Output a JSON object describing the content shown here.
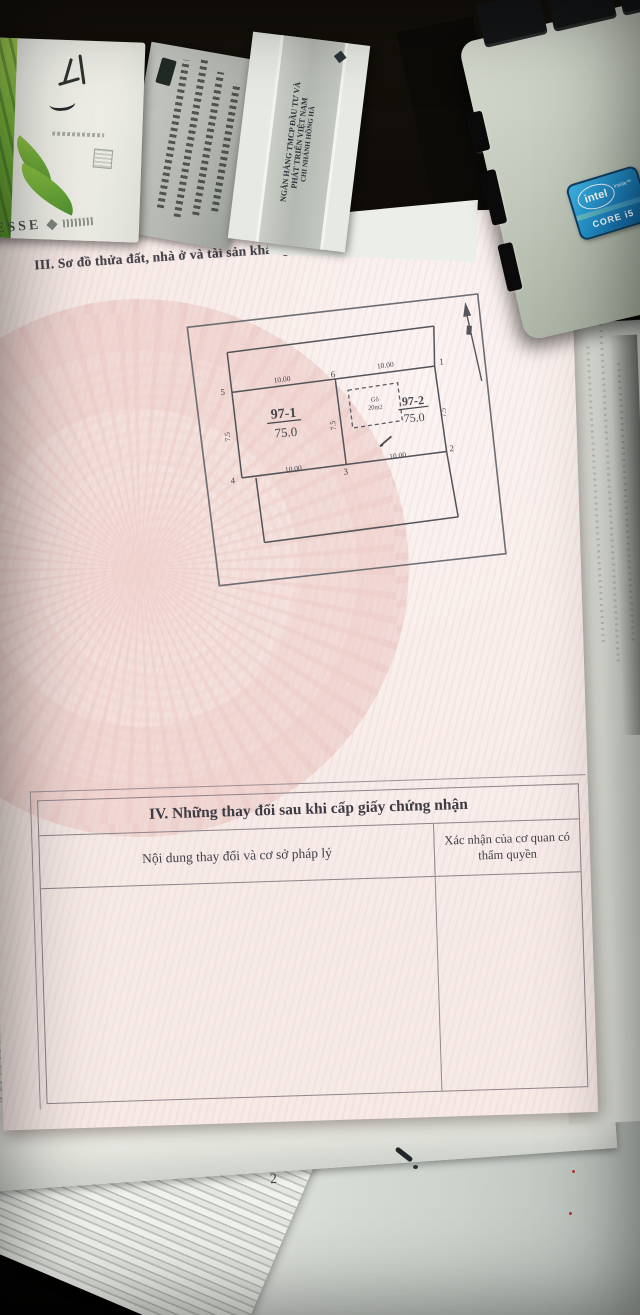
{
  "document": {
    "section3": {
      "heading": "III. Sơ đồ thửa đất, nhà ở và tài sản khác gắn liền với đất"
    },
    "diagram": {
      "plots": {
        "p1_id": "97-1",
        "p1_area": "75.0",
        "p2_id": "97-2",
        "p2_area": "75.0"
      },
      "structure": {
        "type": "Gỗ",
        "area": "20m2"
      },
      "corners": {
        "tl": "5",
        "tm": "6",
        "tr": "1",
        "bl": "4",
        "bm": "3",
        "br": "2"
      },
      "dims": {
        "top_left": "10.00",
        "top_right": "10.00",
        "bottom_left": "10.00",
        "bottom_right": "10.00",
        "side_left": "7.5",
        "side_mid": "7.5",
        "side_right": "7.5"
      }
    },
    "section4": {
      "heading": "IV. Những thay đổi sau khi cấp giấy chứng nhận",
      "col_left": "Nội dung thay đổi và cơ sở pháp lý",
      "col_right": "Xác nhận của cơ quan có thẩm quyền"
    }
  },
  "background": {
    "bank_envelope": {
      "line1": "NGÂN HÀNG TMCP ĐẦU TƯ VÀ",
      "line2": "PHÁT TRIỂN VIỆT NAM",
      "line3": "CHI NHÁNH HỒNG HÀ"
    },
    "cigarette_box": {
      "brand": "ESSE"
    },
    "laptop": {
      "sticker_brand": "intel",
      "sticker_sub": "inside™",
      "sticker_model": "CORE i5"
    },
    "loose_page_number": "2"
  },
  "colors": {
    "certificate_pink": "#f6e9e6",
    "watermark_pink": "#e6b9b4",
    "desk_brown": "#462813",
    "sticker_blue": "#1e88c4",
    "box_green": "#7cb83e",
    "ink": "#46464e"
  }
}
